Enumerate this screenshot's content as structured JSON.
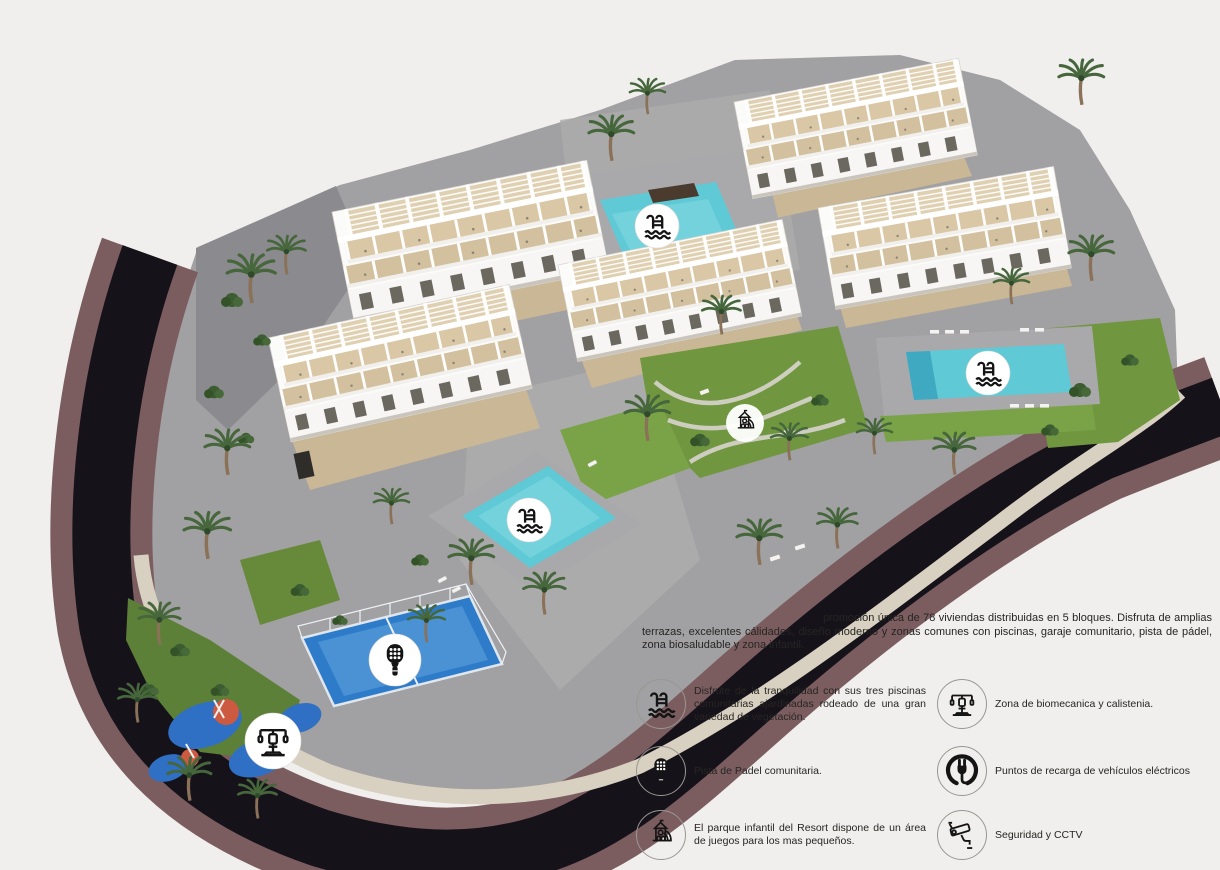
{
  "page": {
    "background": "#f0efed"
  },
  "description": {
    "text": "promoción única de 78 viviendas distribuidas en 5 bloques. Disfruta de amplias terrazas, excelentes cálidades, diseño moderno y zonas comunes con piscinas, garaje comunitario, pista de pádel, zona biosaludable y zona infantil."
  },
  "features": [
    {
      "icon": "pool-icon",
      "text": "Disfrute de la tranquilidad con sus tres piscinas comunitarias ajardinadas rodeado de una gran variedad de vegetación."
    },
    {
      "icon": "biomechanics-icon",
      "text": "Zona de biomecanica y calistenia."
    },
    {
      "icon": "padel-icon",
      "text": "Pista de Padel comunitaria."
    },
    {
      "icon": "ev-charging-icon",
      "text": "Puntos de recarga de vehículos eléctricos"
    },
    {
      "icon": "playground-icon",
      "text": "El parque infantil del Resort dispone de un área de juegos para los mas pequeños."
    },
    {
      "icon": "cctv-icon",
      "text": "Seguridad y CCTV"
    }
  ],
  "site_plan": {
    "map_badges": [
      "pool-icon",
      "pool-icon",
      "pool-icon",
      "playground-icon",
      "padel-icon",
      "biomechanics-icon"
    ],
    "counts": {
      "blocks": 5,
      "pools": 3,
      "padel_courts": 1
    },
    "colors": {
      "road_asphalt": "#16121a",
      "sidewalk_mauve": "#7b5d60",
      "stone_wall": "#d8d0c0",
      "paving_gray": "#a1a0a2",
      "pool_water": "#5fc9d6",
      "padel_court": "#2e7cc9",
      "playground_blue": "#2f6fc4",
      "playground_orange": "#cc5a41",
      "grass": "#70963f",
      "building_white": "#fbfbfa",
      "terrace_beige": "#d9c6a5"
    }
  }
}
